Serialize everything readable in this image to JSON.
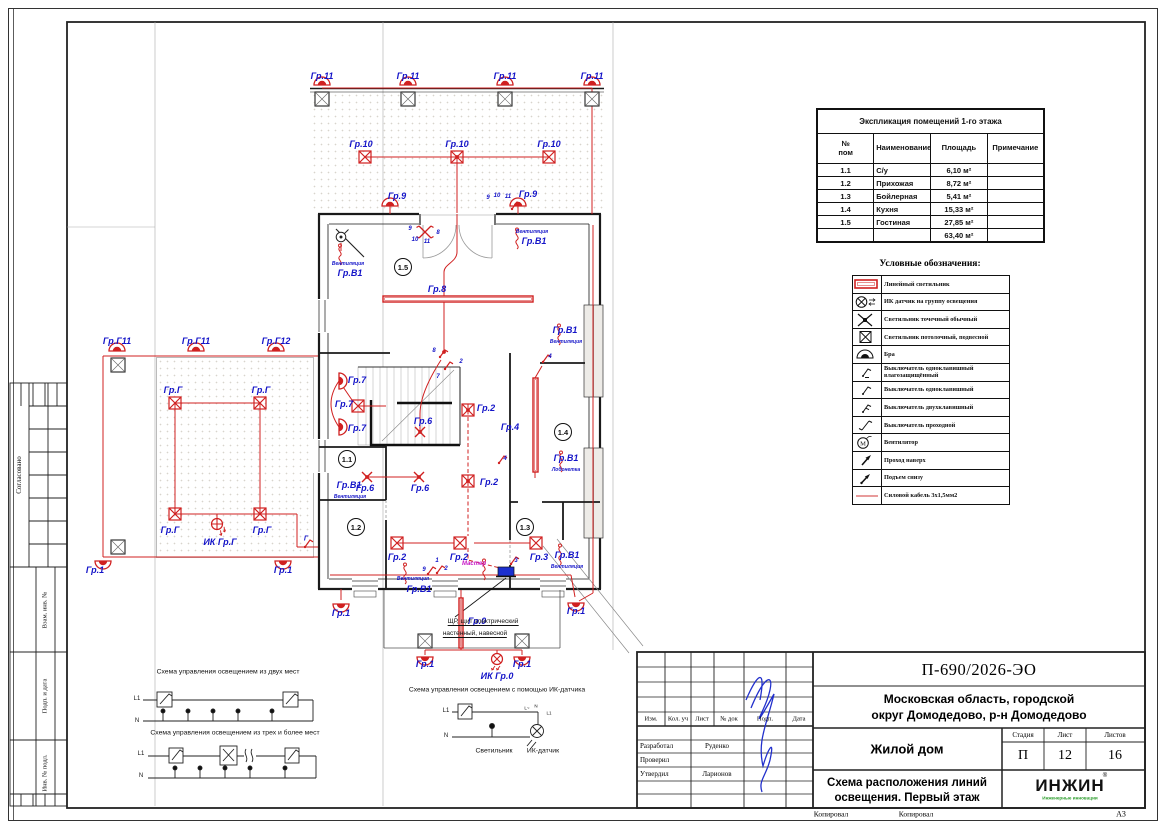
{
  "page": {
    "sheet_format": "А3",
    "copied_label_1": "Копировал",
    "copied_label_2": "Копировал"
  },
  "left_strip": {
    "agreed": "Согласовано",
    "vzam": "Взам. инв. №",
    "podp_data": "Подп. и дата",
    "inv_podl": "Инв. № подл."
  },
  "explication": {
    "title": "Экспликация помещений 1-го этажа",
    "col_num": "№\nпом",
    "col_name": "Наименование",
    "col_area": "Площадь",
    "col_note": "Примечание",
    "rows": [
      {
        "num": "1.1",
        "name": "С/у",
        "area": "6,10 м²",
        "note": ""
      },
      {
        "num": "1.2",
        "name": "Прихожая",
        "area": "8,72 м²",
        "note": ""
      },
      {
        "num": "1.3",
        "name": "Бойлерная",
        "area": "5,41 м²",
        "note": ""
      },
      {
        "num": "1.4",
        "name": "Кухня",
        "area": "15,33 м²",
        "note": ""
      },
      {
        "num": "1.5",
        "name": "Гостиная",
        "area": "27,85 м²",
        "note": ""
      },
      {
        "num": "",
        "name": "",
        "area": "63,40 м²",
        "note": ""
      }
    ]
  },
  "legend": {
    "title": "Условные обозначения:",
    "items": [
      {
        "label": "Линейный светильник"
      },
      {
        "label": "ИК датчик на группу освещения"
      },
      {
        "label": "Светильник точечный обычный"
      },
      {
        "label": "Светильник потолочный, подвесной"
      },
      {
        "label": "Бра"
      },
      {
        "label": "Выключатель одноклавишный влагозащищённый"
      },
      {
        "label": "Выключатель одноклавишный"
      },
      {
        "label": "Выключатель двухклавишный"
      },
      {
        "label": "Выключатель проходной"
      },
      {
        "label": "Вентилятор"
      },
      {
        "label": "Проход наверх"
      },
      {
        "label": "Подъем снизу"
      },
      {
        "label": "Силовой кабель 3х1,5мм2"
      }
    ]
  },
  "title_block": {
    "doc_number": "П-690/2026-ЭО",
    "location_line1": "Московская область, городской",
    "location_line2": "округ Домодедово, р-н Домодедово",
    "object_name": "Жилой дом",
    "sheet_title_line1": "Схема расположения линий",
    "sheet_title_line2": "освещения. Первый этаж",
    "stage_label": "Стадия",
    "sheet_label": "Лист",
    "sheets_label": "Листов",
    "stage": "П",
    "sheet": "12",
    "sheets": "16",
    "cols": {
      "izm": "Изм.",
      "kol": "Кол. уч",
      "list": "Лист",
      "doc": "№ док",
      "podp": "Подп.",
      "data": "Дата"
    },
    "roles": [
      {
        "role": "Разработал",
        "name": "Руденко"
      },
      {
        "role": "Проверил",
        "name": ""
      },
      {
        "role": "Утвердил",
        "name": "Ларионов"
      }
    ],
    "logo_text": "ИНЖИН",
    "logo_reg": "®",
    "logo_sub": "Инженерные инновации"
  },
  "schematics": {
    "two_places_title": "Схема управления освещением из двух мест",
    "three_places_title": "Схема управления освещением из трех и более мест",
    "ir_title": "Схема управления освещением с помощью ИК-датчика",
    "l1": "L1",
    "n": "N",
    "lamp_label": "Светильник",
    "sensor_label": "ИК-датчик",
    "ir_labels": {
      "l_wave": "L~",
      "n": "N",
      "l1": "L1"
    }
  },
  "plan": {
    "panel_note_line1": "ЩР, щит электрический",
    "panel_note_line2": "настенный, навесной",
    "rooms": [
      {
        "id": "1.5",
        "x": 403,
        "y": 267
      },
      {
        "id": "1.1",
        "x": 347,
        "y": 459
      },
      {
        "id": "1.2",
        "x": 356,
        "y": 527
      },
      {
        "id": "1.3",
        "x": 525,
        "y": 527
      },
      {
        "id": "1.4",
        "x": 563,
        "y": 432
      }
    ],
    "labels": [
      {
        "t": "Гр.11",
        "x": 322,
        "y": 76
      },
      {
        "t": "Гр.11",
        "x": 408,
        "y": 76
      },
      {
        "t": "Гр.11",
        "x": 505,
        "y": 76
      },
      {
        "t": "Гр.11",
        "x": 592,
        "y": 76
      },
      {
        "t": "Гр.10",
        "x": 361,
        "y": 144
      },
      {
        "t": "Гр.10",
        "x": 457,
        "y": 144
      },
      {
        "t": "Гр.10",
        "x": 549,
        "y": 144
      },
      {
        "t": "Гр.9",
        "x": 397,
        "y": 196
      },
      {
        "t": "Гр.9",
        "x": 528,
        "y": 194
      },
      {
        "t": "9",
        "x": 488,
        "y": 198,
        "s": 6
      },
      {
        "t": "10",
        "x": 497,
        "y": 196,
        "s": 6
      },
      {
        "t": "11",
        "x": 508,
        "y": 197,
        "s": 6
      },
      {
        "t": "Вентиляция",
        "x": 532,
        "y": 232,
        "s": 5
      },
      {
        "t": "Гр.В1",
        "x": 534,
        "y": 241
      },
      {
        "t": "9",
        "x": 410,
        "y": 229,
        "s": 6
      },
      {
        "t": "10",
        "x": 415,
        "y": 240,
        "s": 6
      },
      {
        "t": "11",
        "x": 427,
        "y": 242,
        "s": 6
      },
      {
        "t": "8",
        "x": 438,
        "y": 233,
        "s": 6
      },
      {
        "t": "Вентиляция",
        "x": 348,
        "y": 264,
        "s": 5
      },
      {
        "t": "Гр.В1",
        "x": 350,
        "y": 273
      },
      {
        "t": "Гр.8",
        "x": 437,
        "y": 289
      },
      {
        "t": "Гр.В1",
        "x": 565,
        "y": 330
      },
      {
        "t": "Вентиляция",
        "x": 566,
        "y": 342,
        "s": 5
      },
      {
        "t": "Гр.Г11",
        "x": 117,
        "y": 341
      },
      {
        "t": "Гр.Г11",
        "x": 196,
        "y": 341
      },
      {
        "t": "Гр.Г12",
        "x": 276,
        "y": 341
      },
      {
        "t": "Гр.Г",
        "x": 173,
        "y": 390
      },
      {
        "t": "Гр.Г",
        "x": 261,
        "y": 390
      },
      {
        "t": "Гр.7",
        "x": 357,
        "y": 380
      },
      {
        "t": "Гр.7",
        "x": 344,
        "y": 404
      },
      {
        "t": "Гр.7",
        "x": 357,
        "y": 428
      },
      {
        "t": "8",
        "x": 434,
        "y": 351,
        "s": 6
      },
      {
        "t": "2",
        "x": 461,
        "y": 362,
        "s": 6
      },
      {
        "t": "7",
        "x": 438,
        "y": 377,
        "s": 6
      },
      {
        "t": "Гр.6",
        "x": 423,
        "y": 421
      },
      {
        "t": "Гр.4",
        "x": 510,
        "y": 427
      },
      {
        "t": "4",
        "x": 550,
        "y": 357,
        "s": 6
      },
      {
        "t": "Гр.2",
        "x": 486,
        "y": 408
      },
      {
        "t": "Гр.В1",
        "x": 566,
        "y": 458
      },
      {
        "t": "Лобонетка",
        "x": 566,
        "y": 470,
        "s": 5
      },
      {
        "t": "4",
        "x": 505,
        "y": 459,
        "s": 6
      },
      {
        "t": "Гр.2",
        "x": 489,
        "y": 482
      },
      {
        "t": "Гр.В1",
        "x": 349,
        "y": 485
      },
      {
        "t": "Вентиляция",
        "x": 350,
        "y": 497,
        "s": 5
      },
      {
        "t": "Гр.6",
        "x": 365,
        "y": 488
      },
      {
        "t": "Гр.6",
        "x": 420,
        "y": 488
      },
      {
        "t": "Гр.Г",
        "x": 170,
        "y": 530
      },
      {
        "t": "Гр.Г",
        "x": 262,
        "y": 530
      },
      {
        "t": "ИК Гр.Г",
        "x": 220,
        "y": 542
      },
      {
        "t": "Гр.2",
        "x": 397,
        "y": 557
      },
      {
        "t": "Гр.2",
        "x": 459,
        "y": 557
      },
      {
        "t": "Гр.3",
        "x": 539,
        "y": 557
      },
      {
        "t": "Гр.В1",
        "x": 567,
        "y": 555
      },
      {
        "t": "Вентиляция",
        "x": 567,
        "y": 567,
        "s": 5
      },
      {
        "t": "Мастер",
        "x": 474,
        "y": 564,
        "s": 6,
        "c": "m"
      },
      {
        "t": "3",
        "x": 516,
        "y": 561,
        "s": 6
      },
      {
        "t": "1",
        "x": 437,
        "y": 561,
        "s": 6
      },
      {
        "t": "2",
        "x": 446,
        "y": 569,
        "s": 6
      },
      {
        "t": "9",
        "x": 424,
        "y": 570,
        "s": 6
      },
      {
        "t": "Г",
        "x": 306,
        "y": 539,
        "s": 7
      },
      {
        "t": "Гр.1",
        "x": 95,
        "y": 570
      },
      {
        "t": "Гр.1",
        "x": 283,
        "y": 570
      },
      {
        "t": "Вентиляция",
        "x": 413,
        "y": 579,
        "s": 5
      },
      {
        "t": "Гр.В1",
        "x": 419,
        "y": 589
      },
      {
        "t": "Гр.1",
        "x": 341,
        "y": 613
      },
      {
        "t": "Гр.1",
        "x": 576,
        "y": 611
      },
      {
        "t": "Гр.0",
        "x": 477,
        "y": 621
      },
      {
        "t": "Гр.1",
        "x": 425,
        "y": 664
      },
      {
        "t": "Гр.1",
        "x": 522,
        "y": 664
      },
      {
        "t": "ИК Гр.0",
        "x": 497,
        "y": 676
      }
    ],
    "symbols": [
      {
        "t": "col",
        "x": 322,
        "y": 99
      },
      {
        "t": "col",
        "x": 408,
        "y": 99
      },
      {
        "t": "col",
        "x": 505,
        "y": 99
      },
      {
        "t": "col",
        "x": 592,
        "y": 99
      },
      {
        "t": "col",
        "x": 118,
        "y": 365
      },
      {
        "t": "col",
        "x": 118,
        "y": 547
      },
      {
        "t": "col",
        "x": 425,
        "y": 641
      },
      {
        "t": "col",
        "x": 522,
        "y": 641
      },
      {
        "t": "bra",
        "x": 322,
        "y": 85
      },
      {
        "t": "bra",
        "x": 408,
        "y": 85
      },
      {
        "t": "bra",
        "x": 505,
        "y": 85
      },
      {
        "t": "bra",
        "x": 592,
        "y": 85
      },
      {
        "t": "bra",
        "x": 390,
        "y": 206
      },
      {
        "t": "bra",
        "x": 518,
        "y": 206
      },
      {
        "t": "bra",
        "x": 117,
        "y": 351
      },
      {
        "t": "bra",
        "x": 196,
        "y": 351
      },
      {
        "t": "bra",
        "x": 276,
        "y": 351
      },
      {
        "t": "bra",
        "x": 103,
        "y": 561,
        "r": 180
      },
      {
        "t": "bra",
        "x": 283,
        "y": 561,
        "r": 180
      },
      {
        "t": "bra",
        "x": 341,
        "y": 604,
        "r": 180
      },
      {
        "t": "bra",
        "x": 576,
        "y": 603,
        "r": 180
      },
      {
        "t": "bra",
        "x": 425,
        "y": 657,
        "r": 180
      },
      {
        "t": "bra",
        "x": 522,
        "y": 657,
        "r": 180
      },
      {
        "t": "bra",
        "x": 339,
        "y": 381,
        "r": 90
      },
      {
        "t": "bra",
        "x": 339,
        "y": 427,
        "r": 90
      },
      {
        "t": "pend",
        "x": 365,
        "y": 157
      },
      {
        "t": "pend",
        "x": 457,
        "y": 157
      },
      {
        "t": "pend",
        "x": 549,
        "y": 157
      },
      {
        "t": "pend",
        "x": 175,
        "y": 403
      },
      {
        "t": "pend",
        "x": 260,
        "y": 403
      },
      {
        "t": "pend",
        "x": 175,
        "y": 514
      },
      {
        "t": "pend",
        "x": 260,
        "y": 514
      },
      {
        "t": "pend",
        "x": 358,
        "y": 406
      },
      {
        "t": "pend",
        "x": 397,
        "y": 543
      },
      {
        "t": "pend",
        "x": 460,
        "y": 543
      },
      {
        "t": "pend",
        "x": 536,
        "y": 543
      },
      {
        "t": "pend",
        "x": 468,
        "y": 410
      },
      {
        "t": "pend",
        "x": 468,
        "y": 481
      },
      {
        "t": "spot",
        "x": 420,
        "y": 432
      },
      {
        "t": "spot",
        "x": 367,
        "y": 477
      },
      {
        "t": "spot",
        "x": 419,
        "y": 477
      },
      {
        "t": "ir",
        "x": 217,
        "y": 524,
        "r": 45
      },
      {
        "t": "ir",
        "x": 497,
        "y": 659,
        "r": 90
      },
      {
        "t": "vent",
        "x": 340,
        "y": 256
      },
      {
        "t": "vent",
        "x": 517,
        "y": 240
      },
      {
        "t": "vent",
        "x": 559,
        "y": 336
      },
      {
        "t": "vent",
        "x": 561,
        "y": 463
      },
      {
        "t": "vent",
        "x": 560,
        "y": 556
      },
      {
        "t": "vent",
        "x": 405,
        "y": 575
      },
      {
        "t": "vent",
        "x": 484,
        "y": 571
      },
      {
        "t": "fanb",
        "x": 341,
        "y": 237
      },
      {
        "t": "sw",
        "x": 512,
        "y": 209
      },
      {
        "t": "sw",
        "x": 440,
        "y": 357
      },
      {
        "t": "sw",
        "x": 445,
        "y": 369
      },
      {
        "t": "sw",
        "x": 543,
        "y": 362
      },
      {
        "t": "sw",
        "x": 499,
        "y": 463
      },
      {
        "t": "sw",
        "x": 511,
        "y": 564
      },
      {
        "t": "sw",
        "x": 437,
        "y": 573
      },
      {
        "t": "sw",
        "x": 428,
        "y": 574
      },
      {
        "t": "sw",
        "x": 305,
        "y": 547
      },
      {
        "t": "swx",
        "x": 425,
        "y": 232
      },
      {
        "t": "lin",
        "x": 383,
        "y": 296,
        "w": 150,
        "h": 6
      },
      {
        "t": "lin",
        "x": 533,
        "y": 378,
        "w": 5,
        "h": 94
      },
      {
        "t": "lin",
        "x": 459,
        "y": 598,
        "w": 4,
        "h": 50
      },
      {
        "t": "shch",
        "x": 506,
        "y": 572
      }
    ]
  },
  "colors": {
    "accent_red": "#d02020",
    "cable_red": "#e07a7a",
    "label_blue": "#1414c8",
    "magenta": "#c617c6",
    "panel_blue": "#1b2fd0",
    "logo_green": "#2f9e2f",
    "signature_blue": "#2230cc"
  }
}
